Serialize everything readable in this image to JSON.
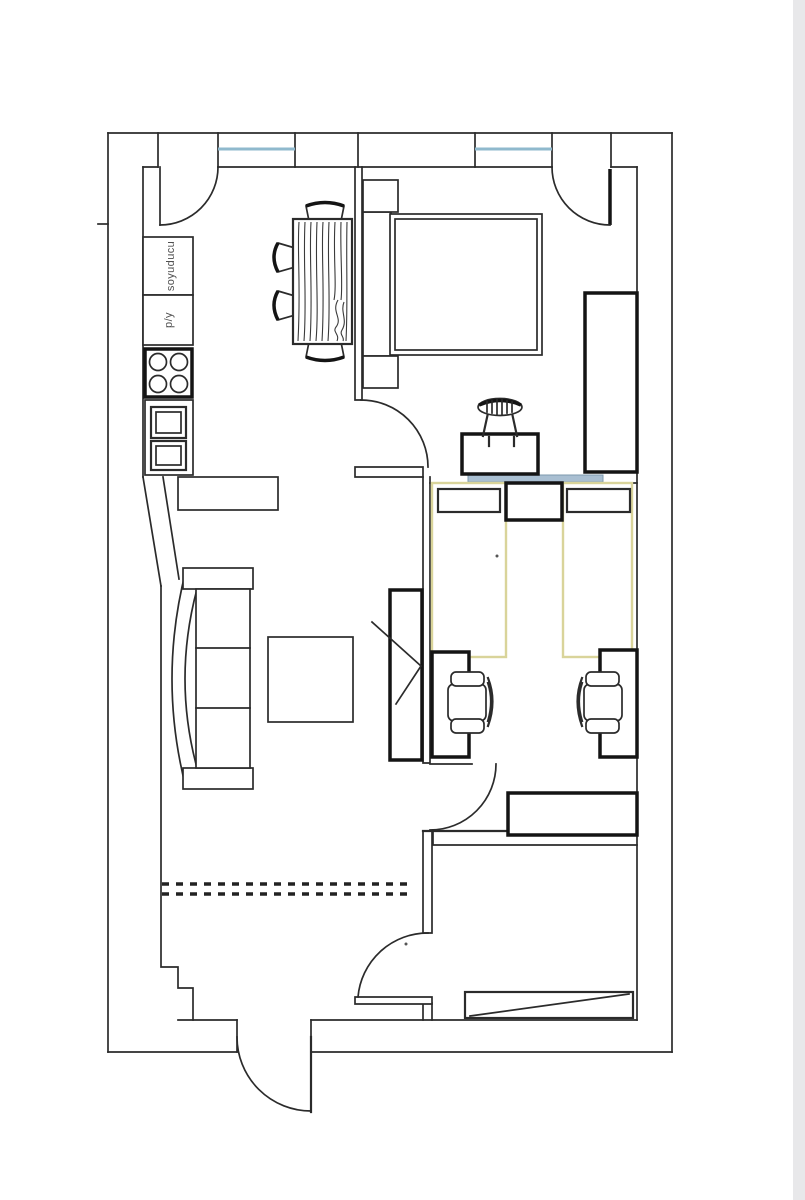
{
  "labels": {
    "fridge": "soyuducu",
    "washer": "p/y"
  },
  "colors": {
    "background": "#ffffff",
    "line": "#2b2b2b",
    "bold_line": "#141414",
    "window_blue": "#8fb9cd",
    "partition_blue": "#a9bfd2",
    "partition_blue_edge": "#7d99ad",
    "bed_yellow": "#d9d49a",
    "side_strip_gray": "#e8e8ea"
  }
}
